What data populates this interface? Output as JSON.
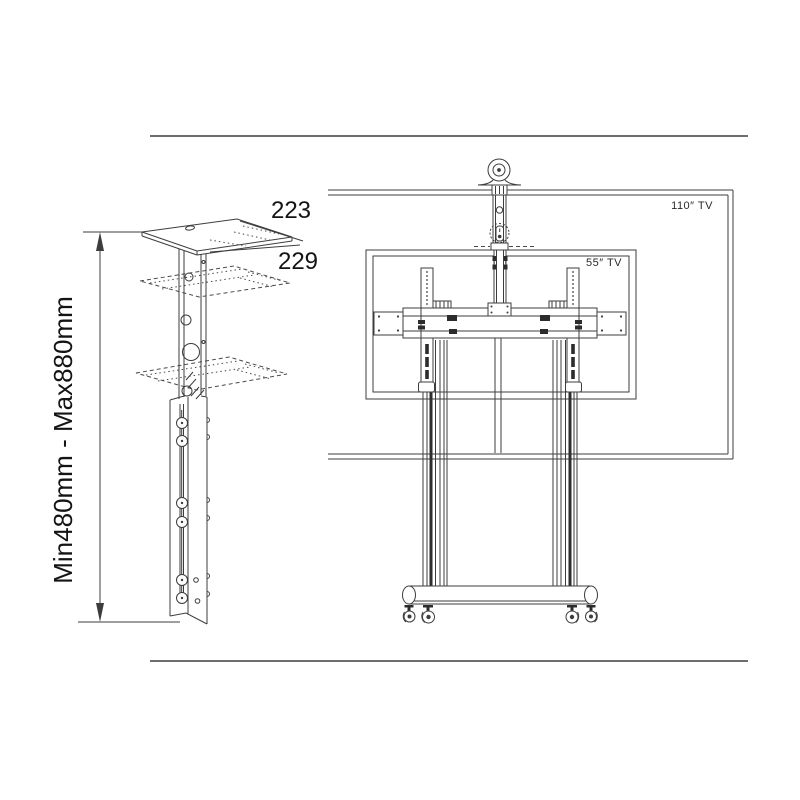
{
  "canvas": {
    "background": "#ffffff",
    "line_color": "#3d3d3d",
    "text_color": "#141414"
  },
  "left_figure": {
    "figure_name": "telescoping-column-with-camera-shelf",
    "labels": {
      "shelf_dim_top": "223",
      "shelf_dim_bottom": "229",
      "height_range": "Min480mm - Max880mm"
    }
  },
  "right_figure": {
    "figure_name": "mobile-tv-cart-front-view",
    "labels": {
      "max_tv_size": "110″ TV",
      "min_tv_size": "55″ TV"
    }
  }
}
